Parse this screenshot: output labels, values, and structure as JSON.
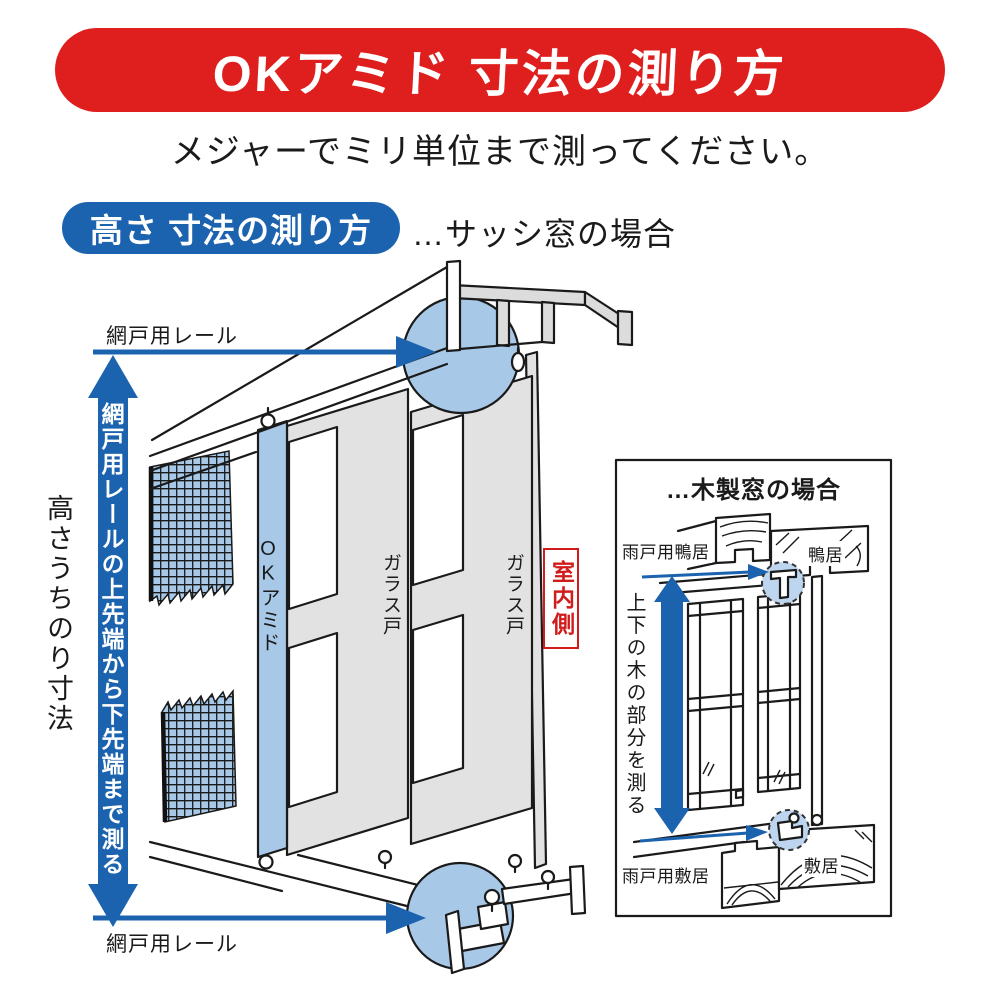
{
  "header": {
    "banner_title": "OKアミド 寸法の測り方",
    "subtitle": "メジャーでミリ単位まで測ってください。"
  },
  "section": {
    "heading": "高さ 寸法の測り方",
    "case_note": "…サッシ窓の場合"
  },
  "sash_diagram": {
    "rail_top_label": "網戸用レール",
    "rail_bottom_label": "網戸用レール",
    "arrow_instruction": "網戸用レールの上先端から下先端まで測る",
    "dimension_label": "高さうちのり寸法",
    "screen_panel_label": "OKアミド",
    "glass_door_front_label": "ガラス戸",
    "glass_door_back_label": "ガラス戸",
    "interior_label": "室内側"
  },
  "wood_diagram": {
    "title": "…木製窓の場合",
    "upper_outer_label": "雨戸用鴨居",
    "upper_inner_label": "鴨居",
    "arrow_instruction": "上下の木の部分を測る",
    "lower_outer_label": "雨戸用敷居",
    "lower_inner_label": "敷居"
  },
  "colors": {
    "banner_red": "#df1f1e",
    "deep_blue": "#1b63ae",
    "light_blue": "#a8c8e8",
    "panel_gray": "#e2e2e2",
    "red_accent": "#d01d1c"
  }
}
